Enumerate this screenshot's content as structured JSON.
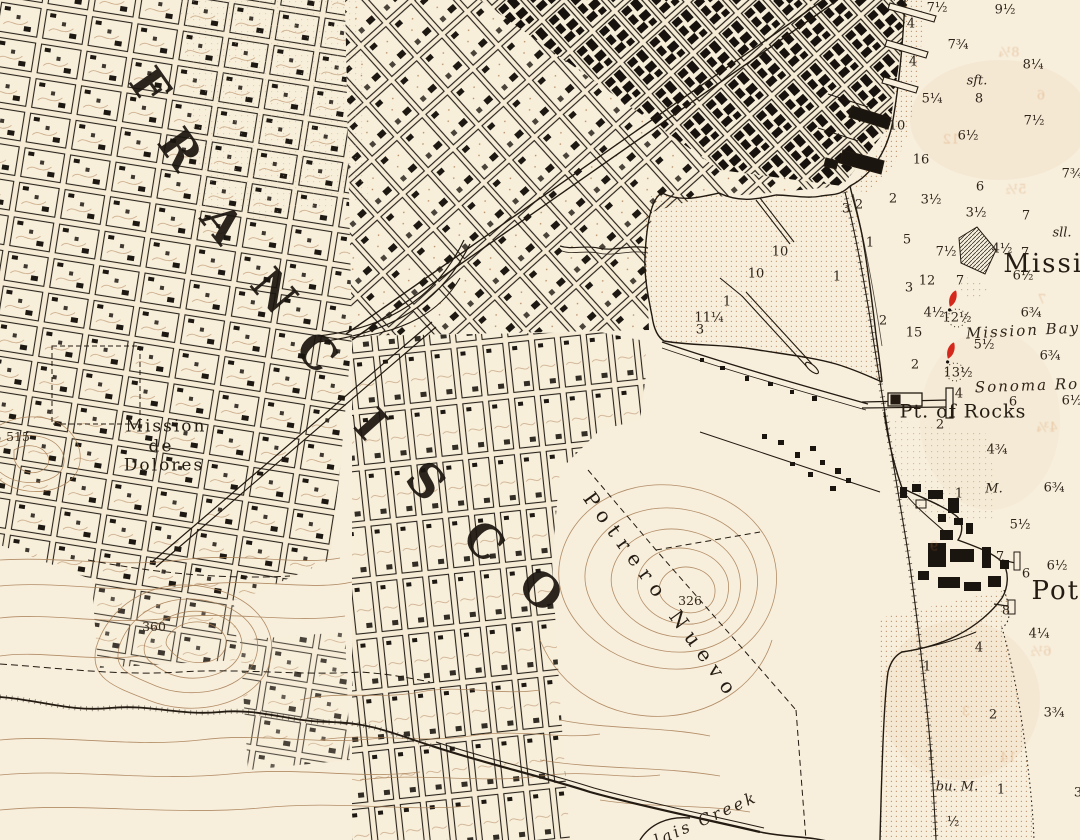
{
  "colors": {
    "paper": "#f7eedc",
    "ink": "#221a10",
    "contour_brown": "#a67c52",
    "stipple_sepia": "#bb8a5f",
    "buoy_red": "#d5281c"
  },
  "big_letters": {
    "word": "FRANCISCO",
    "letters": [
      {
        "v": "F",
        "x": 150,
        "y": 86,
        "rot": 55,
        "fs": 46
      },
      {
        "v": "R",
        "x": 180,
        "y": 149,
        "rot": 55,
        "fs": 46
      },
      {
        "v": "A",
        "x": 222,
        "y": 223,
        "rot": 52,
        "fs": 46
      },
      {
        "v": "N",
        "x": 274,
        "y": 291,
        "rot": 50,
        "fs": 46
      },
      {
        "v": "C",
        "x": 317,
        "y": 352,
        "rot": 48,
        "fs": 46
      },
      {
        "v": "I",
        "x": 371,
        "y": 424,
        "rot": 48,
        "fs": 46
      },
      {
        "v": "S",
        "x": 426,
        "y": 481,
        "rot": 46,
        "fs": 46
      },
      {
        "v": "C",
        "x": 484,
        "y": 541,
        "rot": 44,
        "fs": 46
      },
      {
        "v": "O",
        "x": 541,
        "y": 590,
        "rot": 42,
        "fs": 46
      }
    ]
  },
  "place_labels": [
    {
      "name": "label-mission-de-dolores-1",
      "v": "Mission",
      "x": 166,
      "y": 427,
      "fs": 17,
      "ls": 2,
      "cls": "plc"
    },
    {
      "name": "label-mission-de-dolores-2",
      "v": "de",
      "x": 161,
      "y": 447,
      "fs": 17,
      "ls": 2,
      "cls": "plc"
    },
    {
      "name": "label-mission-de-dolores-3",
      "v": "Dolores",
      "x": 164,
      "y": 466,
      "fs": 17,
      "ls": 2,
      "cls": "plc"
    },
    {
      "name": "label-pt-of-rocks",
      "v": "Pt. of Rocks",
      "x": 963,
      "y": 412,
      "fs": 19,
      "ls": 1,
      "cls": "plc"
    },
    {
      "name": "label-mission-big",
      "v": "Missio",
      "x": 1052,
      "y": 264,
      "fs": 26,
      "ls": 2,
      "cls": "plc"
    },
    {
      "name": "label-potrero-big",
      "v": "Potr",
      "x": 1063,
      "y": 591,
      "fs": 26,
      "ls": 2,
      "cls": "plc"
    },
    {
      "name": "label-mission-bay",
      "v": "Mission Bay",
      "x": 1023,
      "y": 331,
      "fs": 15,
      "ls": 2,
      "rot": -3,
      "cls": "ital"
    },
    {
      "name": "label-sonoma-road",
      "v": "Sonoma Ro",
      "x": 1027,
      "y": 386,
      "fs": 15,
      "ls": 2,
      "rot": -2,
      "cls": "ital"
    },
    {
      "name": "label-potrero-nuevo",
      "v": "Potrero Nuevo",
      "x": 662,
      "y": 596,
      "fs": 20,
      "ls": 8,
      "rot": 54,
      "cls": "plc"
    },
    {
      "name": "label-islais-creek",
      "v": "lais Creek",
      "x": 706,
      "y": 819,
      "fs": 16,
      "ls": 3,
      "rot": -24,
      "cls": "ital"
    }
  ],
  "soundings": [
    {
      "v": "7½",
      "x": 937,
      "y": 8
    },
    {
      "v": "9½",
      "x": 1005,
      "y": 10
    },
    {
      "v": "4",
      "x": 911,
      "y": 24
    },
    {
      "v": "7¾",
      "x": 958,
      "y": 45
    },
    {
      "v": "4",
      "x": 913,
      "y": 62
    },
    {
      "v": "8¼",
      "x": 1033,
      "y": 65
    },
    {
      "v": "5¼",
      "x": 932,
      "y": 99
    },
    {
      "v": "8",
      "x": 979,
      "y": 99
    },
    {
      "v": "7½",
      "x": 1034,
      "y": 121
    },
    {
      "v": "10",
      "x": 897,
      "y": 126
    },
    {
      "v": "6½",
      "x": 968,
      "y": 136
    },
    {
      "v": "16",
      "x": 921,
      "y": 160
    },
    {
      "v": "7¾",
      "x": 1072,
      "y": 174
    },
    {
      "v": "6",
      "x": 980,
      "y": 187
    },
    {
      "v": "2",
      "x": 893,
      "y": 199
    },
    {
      "v": "3½",
      "x": 931,
      "y": 200
    },
    {
      "v": "3½",
      "x": 976,
      "y": 213
    },
    {
      "v": "7",
      "x": 1026,
      "y": 216
    },
    {
      "v": "3",
      "x": 846,
      "y": 209
    },
    {
      "v": "2",
      "x": 859,
      "y": 205
    },
    {
      "v": "5",
      "x": 907,
      "y": 240
    },
    {
      "v": "7½",
      "x": 946,
      "y": 252
    },
    {
      "v": "4½",
      "x": 1002,
      "y": 249
    },
    {
      "v": "7",
      "x": 1025,
      "y": 253
    },
    {
      "v": "6½",
      "x": 1023,
      "y": 276
    },
    {
      "v": "3",
      "x": 909,
      "y": 288
    },
    {
      "v": "12",
      "x": 927,
      "y": 281
    },
    {
      "v": "7",
      "x": 960,
      "y": 281
    },
    {
      "v": "1",
      "x": 870,
      "y": 243
    },
    {
      "v": "1",
      "x": 837,
      "y": 277
    },
    {
      "v": "2",
      "x": 883,
      "y": 321
    },
    {
      "v": "10",
      "x": 780,
      "y": 252
    },
    {
      "v": "10",
      "x": 756,
      "y": 274
    },
    {
      "v": "1",
      "x": 727,
      "y": 302
    },
    {
      "v": "11¼",
      "x": 709,
      "y": 318
    },
    {
      "v": "3",
      "x": 700,
      "y": 330
    },
    {
      "v": "4½",
      "x": 934,
      "y": 313
    },
    {
      "v": "12½",
      "x": 957,
      "y": 318
    },
    {
      "v": "6¾",
      "x": 1031,
      "y": 313
    },
    {
      "v": "15",
      "x": 914,
      "y": 333
    },
    {
      "v": "5½",
      "x": 984,
      "y": 345
    },
    {
      "v": "6¾",
      "x": 1050,
      "y": 356
    },
    {
      "v": "2",
      "x": 915,
      "y": 365
    },
    {
      "v": "13½",
      "x": 958,
      "y": 373
    },
    {
      "v": "4",
      "x": 959,
      "y": 394
    },
    {
      "v": "6",
      "x": 1013,
      "y": 402
    },
    {
      "v": "6½",
      "x": 1072,
      "y": 401
    },
    {
      "v": "2",
      "x": 940,
      "y": 425
    },
    {
      "v": "4¾",
      "x": 997,
      "y": 450
    },
    {
      "v": "1",
      "x": 959,
      "y": 494
    },
    {
      "v": "6¾",
      "x": 1054,
      "y": 488
    },
    {
      "v": "5½",
      "x": 1020,
      "y": 525
    },
    {
      "v": "7",
      "x": 1000,
      "y": 557
    },
    {
      "v": "6½",
      "x": 1057,
      "y": 566
    },
    {
      "v": "6",
      "x": 1026,
      "y": 574
    },
    {
      "v": "8",
      "x": 1006,
      "y": 611
    },
    {
      "v": "4¼",
      "x": 1039,
      "y": 634
    },
    {
      "v": "4",
      "x": 979,
      "y": 648
    },
    {
      "v": "1",
      "x": 927,
      "y": 667
    },
    {
      "v": "2",
      "x": 993,
      "y": 715
    },
    {
      "v": "3¾",
      "x": 1054,
      "y": 713
    },
    {
      "v": "1",
      "x": 931,
      "y": 756
    },
    {
      "v": "1",
      "x": 1001,
      "y": 790
    },
    {
      "v": "½",
      "x": 953,
      "y": 822
    },
    {
      "v": "3",
      "x": 1078,
      "y": 793
    }
  ],
  "bottom_notes": [
    {
      "v": "sft.",
      "x": 977,
      "y": 81
    },
    {
      "v": "sll.",
      "x": 1062,
      "y": 233
    },
    {
      "v": "M.",
      "x": 994,
      "y": 489
    },
    {
      "v": "bu. M.",
      "x": 957,
      "y": 787
    }
  ],
  "elevations": [
    {
      "v": "515",
      "x": 18,
      "y": 437
    },
    {
      "v": "360",
      "x": 154,
      "y": 627
    },
    {
      "v": "326",
      "x": 690,
      "y": 601
    }
  ],
  "ghosts": [
    {
      "v": "8¼",
      "x": 1009,
      "y": 53,
      "flip": true
    },
    {
      "v": "6",
      "x": 1041,
      "y": 96,
      "flip": true
    },
    {
      "v": "12",
      "x": 951,
      "y": 140,
      "flip": true
    },
    {
      "v": "5½",
      "x": 1016,
      "y": 190,
      "flip": true
    },
    {
      "v": "7",
      "x": 1042,
      "y": 300,
      "flip": true
    },
    {
      "v": "4¾",
      "x": 1047,
      "y": 428,
      "flip": true
    },
    {
      "v": "9",
      "x": 934,
      "y": 547,
      "flip": true
    },
    {
      "v": "6½",
      "x": 1041,
      "y": 652,
      "flip": true
    },
    {
      "v": "3",
      "x": 966,
      "y": 712,
      "flip": true
    },
    {
      "v": "14",
      "x": 1008,
      "y": 758,
      "flip": true
    }
  ]
}
